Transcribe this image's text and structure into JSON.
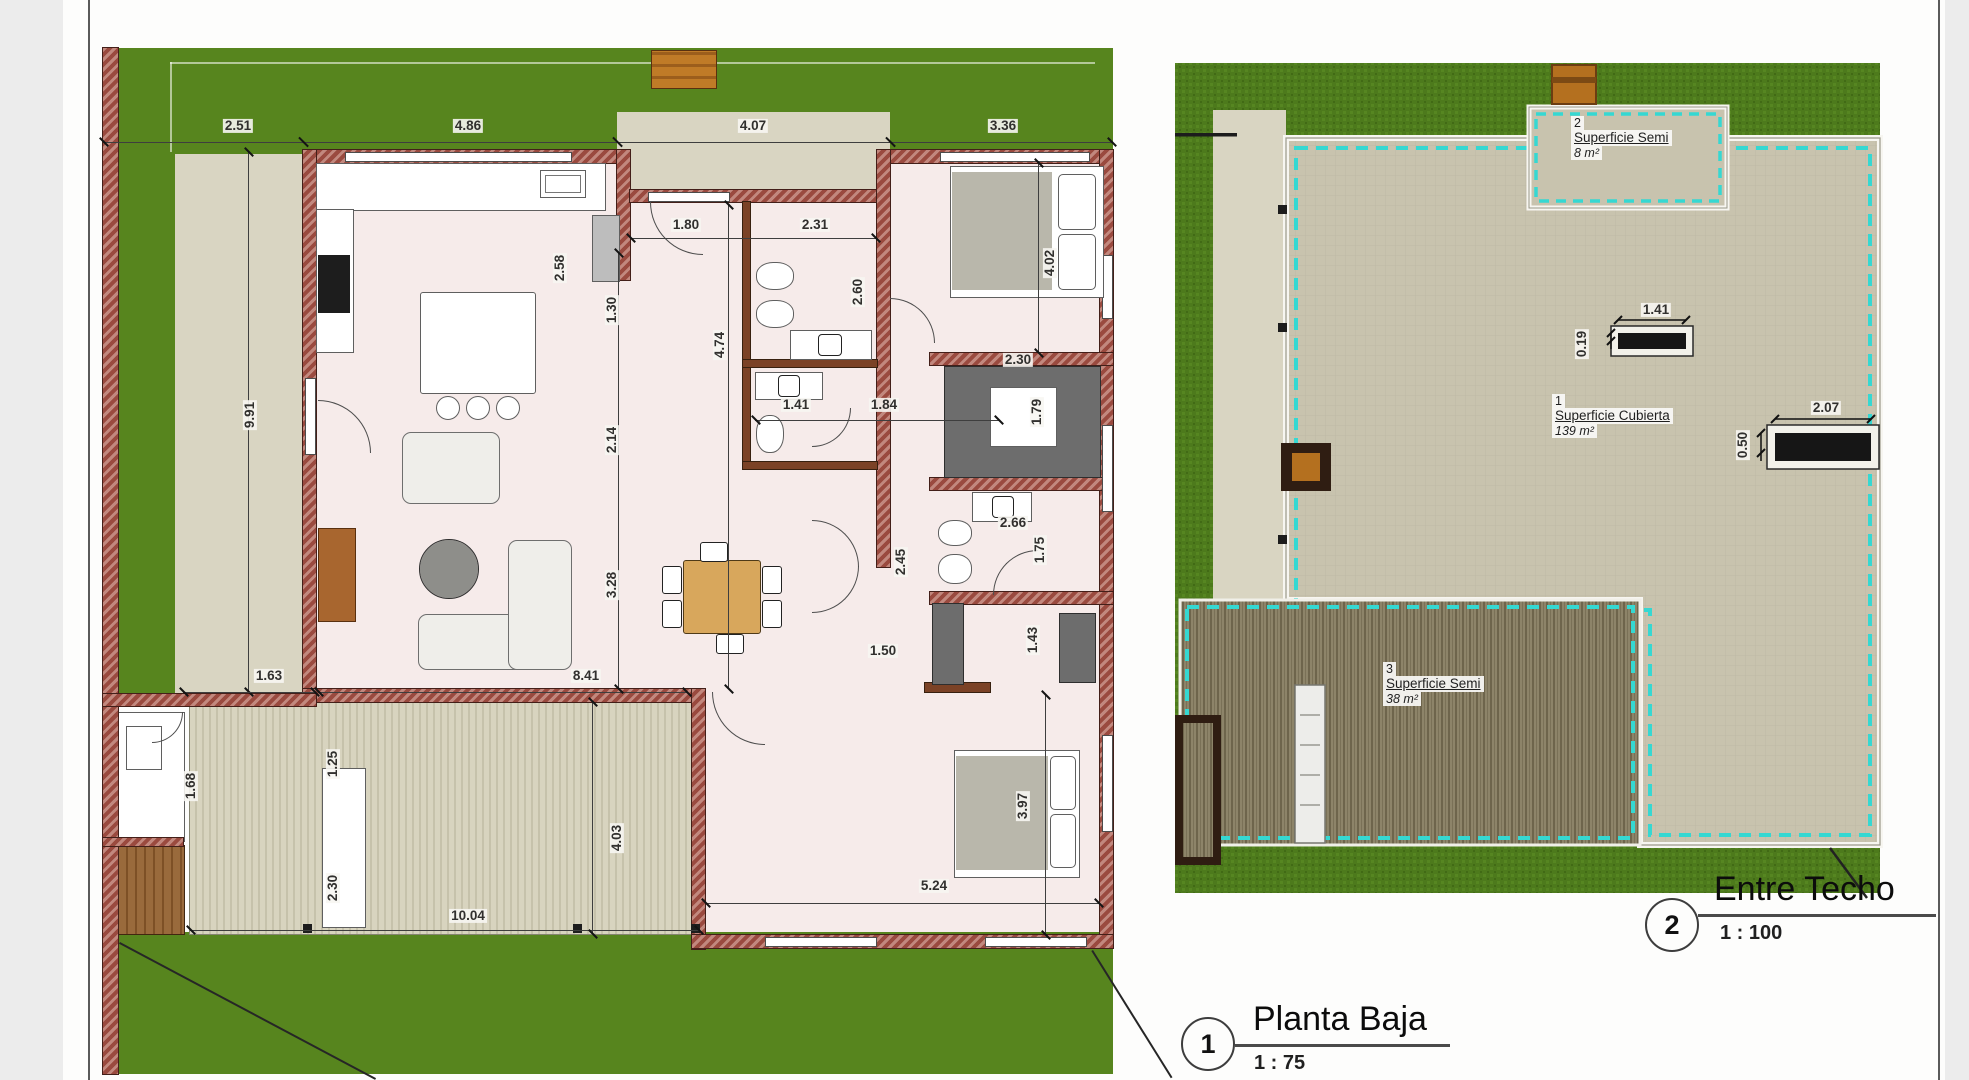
{
  "sheet": {
    "background": "#fdfdfc",
    "border_color": "#5a5a5a"
  },
  "floor_plan": {
    "marker_number": "1",
    "title": "Planta Baja",
    "scale": "1 : 75",
    "dims": [
      {
        "t": "2.51",
        "x": 238,
        "y": 126
      },
      {
        "t": "4.86",
        "x": 468,
        "y": 126
      },
      {
        "t": "4.07",
        "x": 753,
        "y": 126
      },
      {
        "t": "3.36",
        "x": 1003,
        "y": 126
      },
      {
        "t": "2.58",
        "x": 560,
        "y": 268,
        "v": 1
      },
      {
        "t": "1.80",
        "x": 686,
        "y": 225
      },
      {
        "t": "2.31",
        "x": 815,
        "y": 225
      },
      {
        "t": "2.60",
        "x": 858,
        "y": 292,
        "v": 1
      },
      {
        "t": "4.02",
        "x": 1050,
        "y": 263,
        "v": 1
      },
      {
        "t": "9.91",
        "x": 250,
        "y": 415,
        "v": 1
      },
      {
        "t": "1.30",
        "x": 612,
        "y": 310,
        "v": 1
      },
      {
        "t": "4.74",
        "x": 720,
        "y": 345,
        "v": 1
      },
      {
        "t": "2.14",
        "x": 612,
        "y": 440,
        "v": 1
      },
      {
        "t": "2.30",
        "x": 1018,
        "y": 360
      },
      {
        "t": "1.79",
        "x": 1037,
        "y": 412,
        "v": 1
      },
      {
        "t": "1.41",
        "x": 796,
        "y": 405
      },
      {
        "t": "1.84",
        "x": 884,
        "y": 405
      },
      {
        "t": "2.66",
        "x": 1013,
        "y": 523
      },
      {
        "t": "1.75",
        "x": 1040,
        "y": 550,
        "v": 1
      },
      {
        "t": "2.45",
        "x": 901,
        "y": 562,
        "v": 1
      },
      {
        "t": "3.28",
        "x": 612,
        "y": 585,
        "v": 1
      },
      {
        "t": "8.41",
        "x": 586,
        "y": 676
      },
      {
        "t": "1.50",
        "x": 883,
        "y": 651
      },
      {
        "t": "1.43",
        "x": 1033,
        "y": 640,
        "v": 1
      },
      {
        "t": "1.63",
        "x": 269,
        "y": 676
      },
      {
        "t": "1.68",
        "x": 191,
        "y": 786,
        "v": 1
      },
      {
        "t": "1.25",
        "x": 333,
        "y": 764,
        "v": 1
      },
      {
        "t": "2.30",
        "x": 333,
        "y": 888,
        "v": 1
      },
      {
        "t": "10.04",
        "x": 468,
        "y": 916
      },
      {
        "t": "4.03",
        "x": 617,
        "y": 838,
        "v": 1
      },
      {
        "t": "5.24",
        "x": 934,
        "y": 886
      },
      {
        "t": "3.97",
        "x": 1023,
        "y": 806,
        "v": 1
      }
    ]
  },
  "roof_plan": {
    "marker_number": "2",
    "title": "Entre Techo",
    "scale": "1 : 100",
    "area_labels": [
      {
        "num": "2",
        "name": "Superficie Semi",
        "area": "8 m²",
        "x": 1571,
        "y": 116
      },
      {
        "num": "1",
        "name": "Superficie Cubierta",
        "area": "139 m²",
        "x": 1552,
        "y": 394
      },
      {
        "num": "3",
        "name": "Superficie Semi",
        "area": "38 m²",
        "x": 1383,
        "y": 662
      }
    ],
    "dims": [
      {
        "t": "1.41",
        "x": 1656,
        "y": 310
      },
      {
        "t": "0.19",
        "x": 1582,
        "y": 344,
        "v": 1
      },
      {
        "t": "2.07",
        "x": 1826,
        "y": 408
      },
      {
        "t": "0.50",
        "x": 1743,
        "y": 445,
        "v": 1
      }
    ]
  },
  "colors": {
    "lawn": "#57851e",
    "roof_slab": "#c8c3ae",
    "wall": "#9a4a3f",
    "wood_partition": "#7b4226",
    "floor": "#f6ebea",
    "paving": "#d9d5c2",
    "cyan_boundary": "#35d8d2",
    "wood_table": "#d8a75c"
  }
}
